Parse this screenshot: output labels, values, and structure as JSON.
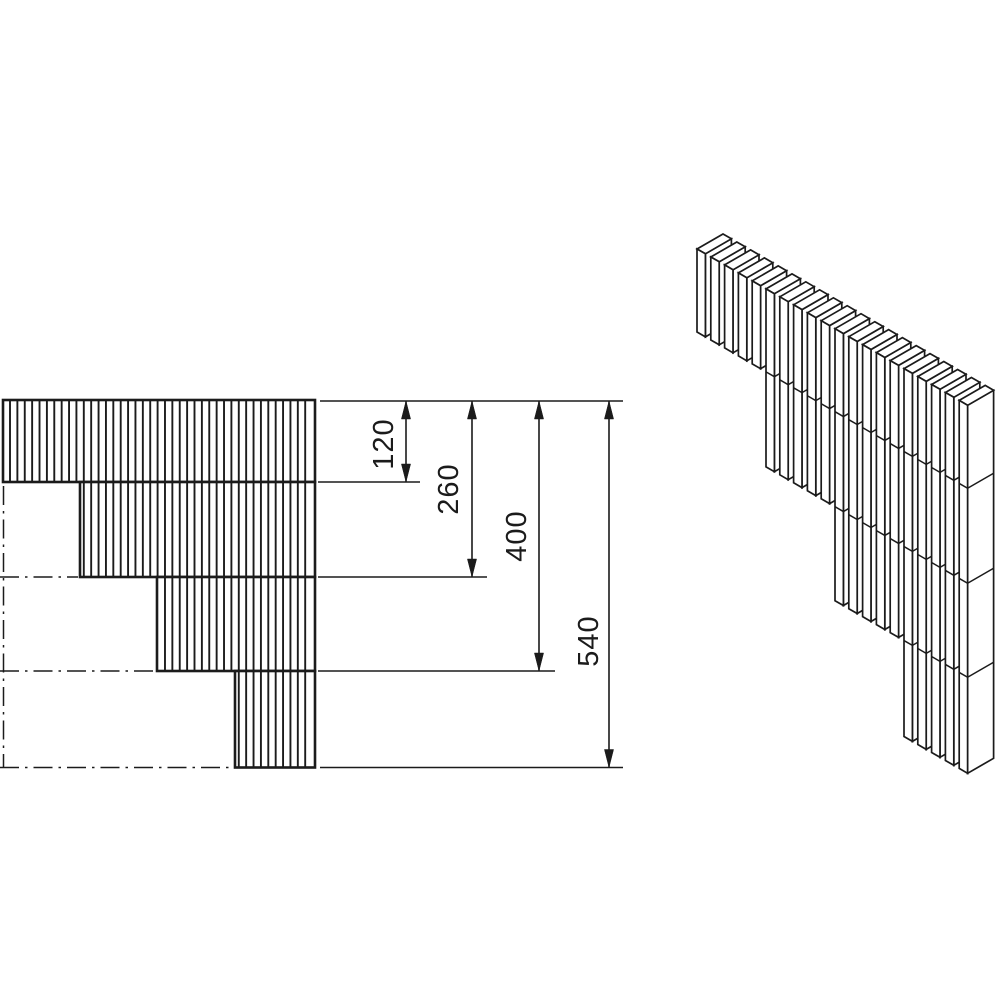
{
  "drawing": {
    "background_color": "#ffffff",
    "line_color": "#1b1b1b",
    "dimensions": [
      {
        "label": "120",
        "value_mm": 120
      },
      {
        "label": "260",
        "value_mm": 260
      },
      {
        "label": "400",
        "value_mm": 400
      },
      {
        "label": "540",
        "value_mm": 540
      }
    ],
    "front_view": {
      "description": "stepped hatched profile, 4 bands stepping down to the right",
      "steps": 4,
      "step_heights_mm": [
        120,
        140,
        140,
        140
      ]
    },
    "iso_view": {
      "description": "isometric view of stepped vertical-slat wall",
      "steps": 4,
      "slats_per_step": [
        5,
        5,
        5,
        5
      ]
    }
  }
}
